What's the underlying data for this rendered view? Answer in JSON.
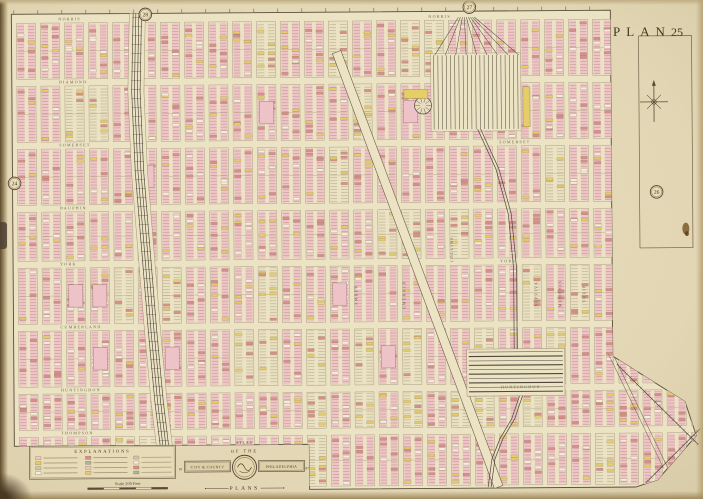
{
  "plate": {
    "title": "PLAN",
    "number": "25"
  },
  "adjacent_plate_badges": [
    {
      "number": "28",
      "x": 147,
      "y": 13
    },
    {
      "number": "27",
      "x": 471,
      "y": 8
    },
    {
      "number": "26",
      "x": 657,
      "y": 194
    },
    {
      "number": "24",
      "x": 15,
      "y": 181
    }
  ],
  "legend": {
    "title": "EXPLANATIONS",
    "scale_label": "Scale 200 Feet",
    "chips": [
      "#efc6c6",
      "#e5cd68",
      "#cfc7b2",
      "#f4eedb",
      "#d98e8a",
      "#aab49e",
      "#efc6c6",
      "#e5cd68",
      "#cfc7b2",
      "#f4eedb",
      "#d98e8a",
      "#aab49e"
    ]
  },
  "cartouche": {
    "top_label": "ATLAS",
    "arc_label": "OF THE",
    "left_ribbon": "CITY & COUNTY",
    "right_ribbon": "PHILADELPHIA",
    "bottom_label": "PLANS",
    "year_left": "18",
    "year_right": "87"
  },
  "streets": {
    "horizontal": [
      {
        "name": "NORRIS",
        "y": 17,
        "x": [
          60,
          430
        ]
      },
      {
        "name": "DIAMOND",
        "y": 80,
        "x": [
          60
        ]
      },
      {
        "name": "SOMERSET",
        "y": 143,
        "x": [
          60,
          500
        ]
      },
      {
        "name": "DAUPHIN",
        "y": 206,
        "x": [
          60
        ]
      },
      {
        "name": "YORK",
        "y": 262,
        "x": [
          60,
          500
        ]
      },
      {
        "name": "CUMBERLAND",
        "y": 325,
        "x": [
          60
        ]
      },
      {
        "name": "HUNTINGDON",
        "y": 388,
        "x": [
          60,
          500
        ]
      },
      {
        "name": "THOMPSON",
        "y": 431,
        "x": [
          60
        ]
      }
    ],
    "vertical": [
      {
        "name": "AMBER",
        "x": 357,
        "y": 295
      },
      {
        "name": "EMERALD",
        "x": 405,
        "y": 295
      },
      {
        "name": "COLLINS",
        "x": 453,
        "y": 250
      },
      {
        "name": "SEPVIVA",
        "x": 537,
        "y": 295
      },
      {
        "name": "MEMPHIS",
        "x": 561,
        "y": 295
      },
      {
        "name": "TULIP",
        "x": 585,
        "y": 295
      }
    ]
  },
  "colors": {
    "paper": "#e2d6b4",
    "map_bg": "#ece3c5",
    "block_pink": "#efc6c6",
    "lot_line_pink": "#c29393",
    "block_cream": "#eae1c0",
    "lot_line_gray": "#b3a88e",
    "building_red": "#d98e8a",
    "building_yellow": "#e5cd68",
    "building_white": "#f4eedb",
    "ink": "#5a4c38",
    "ink_light": "#9a8a6c",
    "rail": "#4e463a",
    "label": "#6f6047",
    "badge_fill": "#e9dcb8"
  }
}
